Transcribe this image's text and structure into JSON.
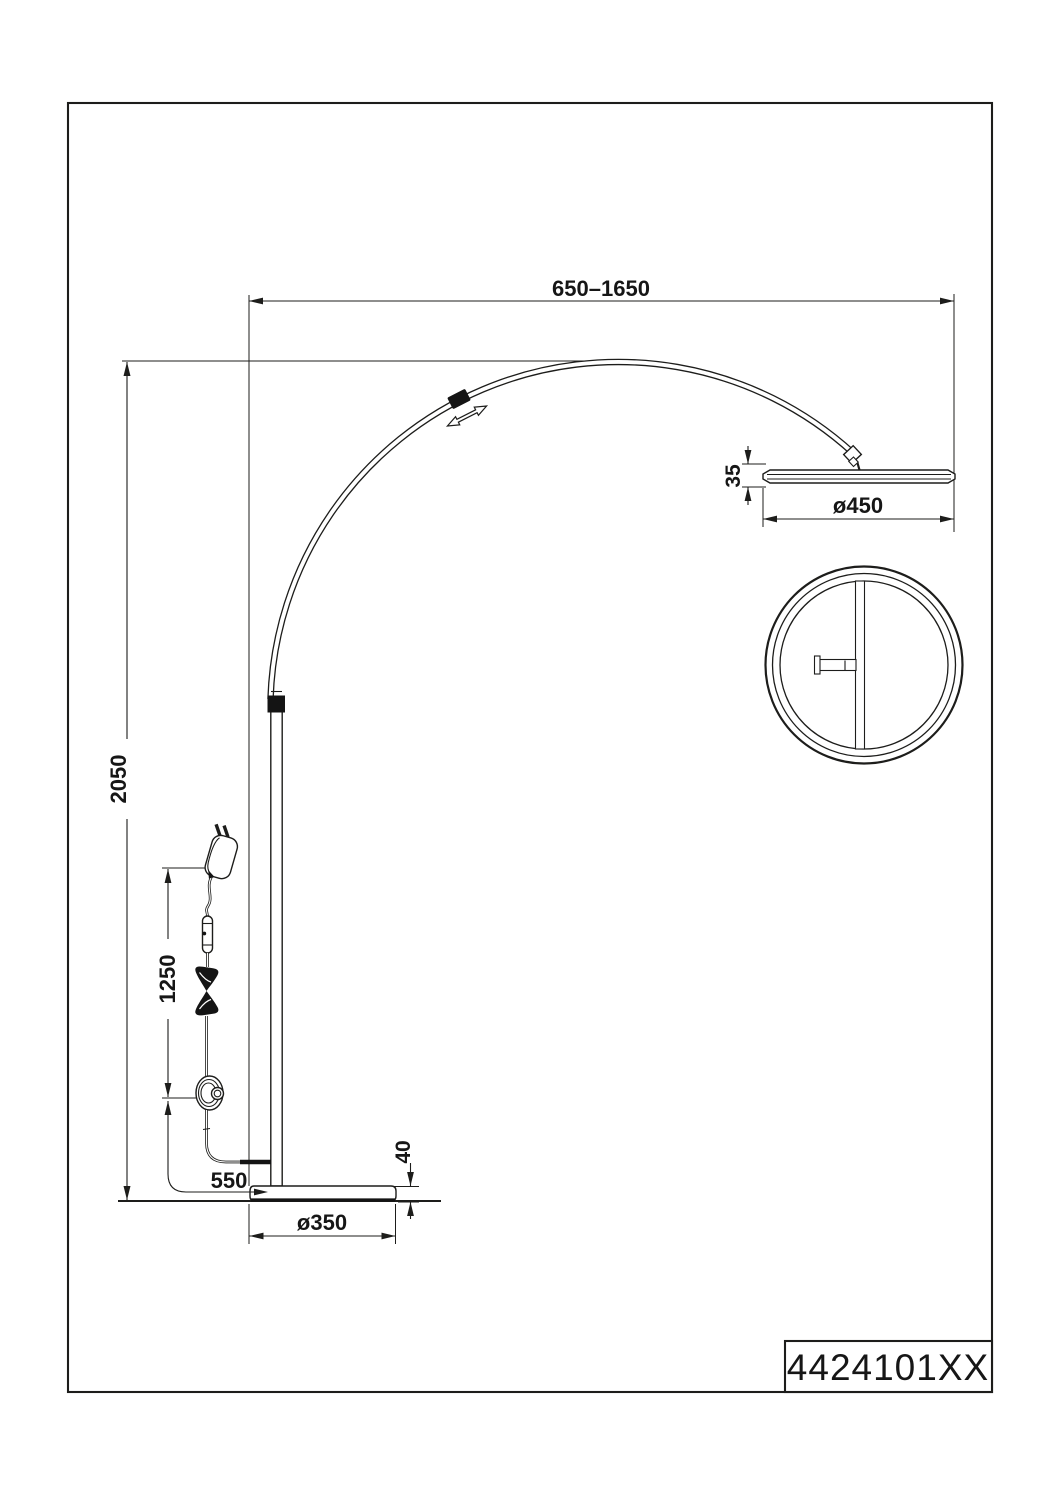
{
  "title_block": {
    "part_number": "4424101XX"
  },
  "dimensions": {
    "arm_reach": "650–1650",
    "total_height": "2050",
    "head_thickness": "35",
    "head_diameter": "ø450",
    "cable_plug_to_switch": "1250",
    "cable_switch_to_pole": "550",
    "base_thickness": "40",
    "base_diameter": "ø350"
  },
  "colors": {
    "line": "#1d1d1b",
    "background": "#ffffff"
  }
}
